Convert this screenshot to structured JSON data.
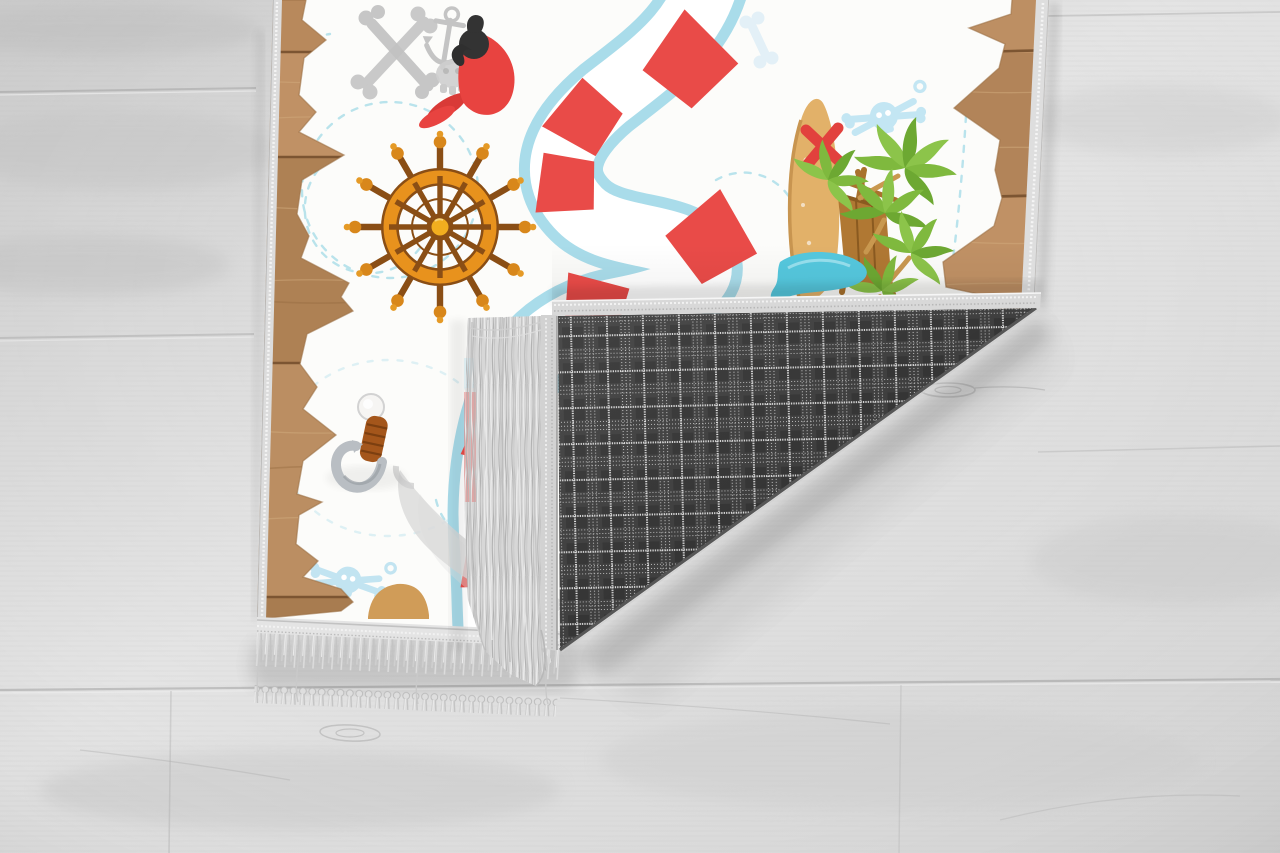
{
  "image_type": "product-photo",
  "canvas": {
    "width": 1280,
    "height": 853
  },
  "scene": {
    "description": "Children's pirate treasure-map rug lying on a light gray wooden floor; bottom-right corner folded over showing dark gray tartan backing and light gray fringe",
    "floor": {
      "material": "whitewashed wood planks with grain and knots"
    },
    "rug": {
      "front_theme": "pirate treasure map on torn parchment over wooden planks",
      "elements": [
        "wood-plank torn-edge border",
        "faded gray crossed bones",
        "faded gray anchor",
        "faded gray skull",
        "red parrot with black head",
        "light bone watermark",
        "ship steering wheel",
        "winding red and white striped game path with light blue edges",
        "dashed travel trails",
        "treasure island with tan sail, red X mark, masts, boat hut, palm trees and water ribbon",
        "light blue skull-and-crossbones watermarks",
        "pirate hook with wooden grip",
        "faded gray cutlass"
      ],
      "back_pattern": "dark gray tartan plaid with dotted white lines",
      "edge_finish": "light gray bindings and knotted fringe tassels"
    }
  },
  "palette": {
    "floor_light": "#e9e9e9",
    "floor_mid": "#dadada",
    "floor_dark": "#c5c5c5",
    "parchment": "#fcfcfa",
    "wood_border": "#b88a5c",
    "wood_border_light": "#c29165",
    "wood_border_dark": "#a87c50",
    "wood_seam": "#7c5532",
    "wood_grain": "#d2ab7e",
    "wood_tongue": "#d09c58",
    "binding_gray": "#d8d8d8",
    "fringe_gray": "#d7d7d7",
    "fringe_dark": "#b5b5b5",
    "fringe_light": "#efefef",
    "plaid_dark": "#3c3c3c",
    "plaid_square": "#323232",
    "plaid_line": "#cdcdcd",
    "plaid_line_strong": "#eaeaea",
    "path_blue": "#a9dcea",
    "path_white": "#ffffff",
    "path_red": "#e94b48",
    "trail_blue": "#a8dce8",
    "faded_gray": "#c9c9c9",
    "parrot_red": "#e84340",
    "parrot_dark_red": "#d93a37",
    "parrot_black": "#333333",
    "wheel_orange": "#e8921d",
    "wheel_brown": "#8a4e15",
    "wheel_gold": "#f2ae1f",
    "wheel_knob": "#d8871b",
    "sail_tan": "#e2b169",
    "sail_edge": "#c89550",
    "x_red": "#e2413d",
    "mast_brown": "#a9722d",
    "boat_brown": "#b07833",
    "palm_green": "#7fb93e",
    "palm_green_light": "#8cc44a",
    "palm_green_dark": "#6da832",
    "trunk_tan": "#c9984f",
    "water_blue": "#55c8de",
    "water_light": "#9fe2ef",
    "watermark_blue": "#c3e6f3",
    "hook_metal": "#b9bec3",
    "hook_metal_dark": "#9aa0a5",
    "hook_grip": "#a4561b",
    "hook_grip_dark": "#7c3f10",
    "pommel_white": "#f6f5f3",
    "cutlass_gray": "#dadada"
  }
}
